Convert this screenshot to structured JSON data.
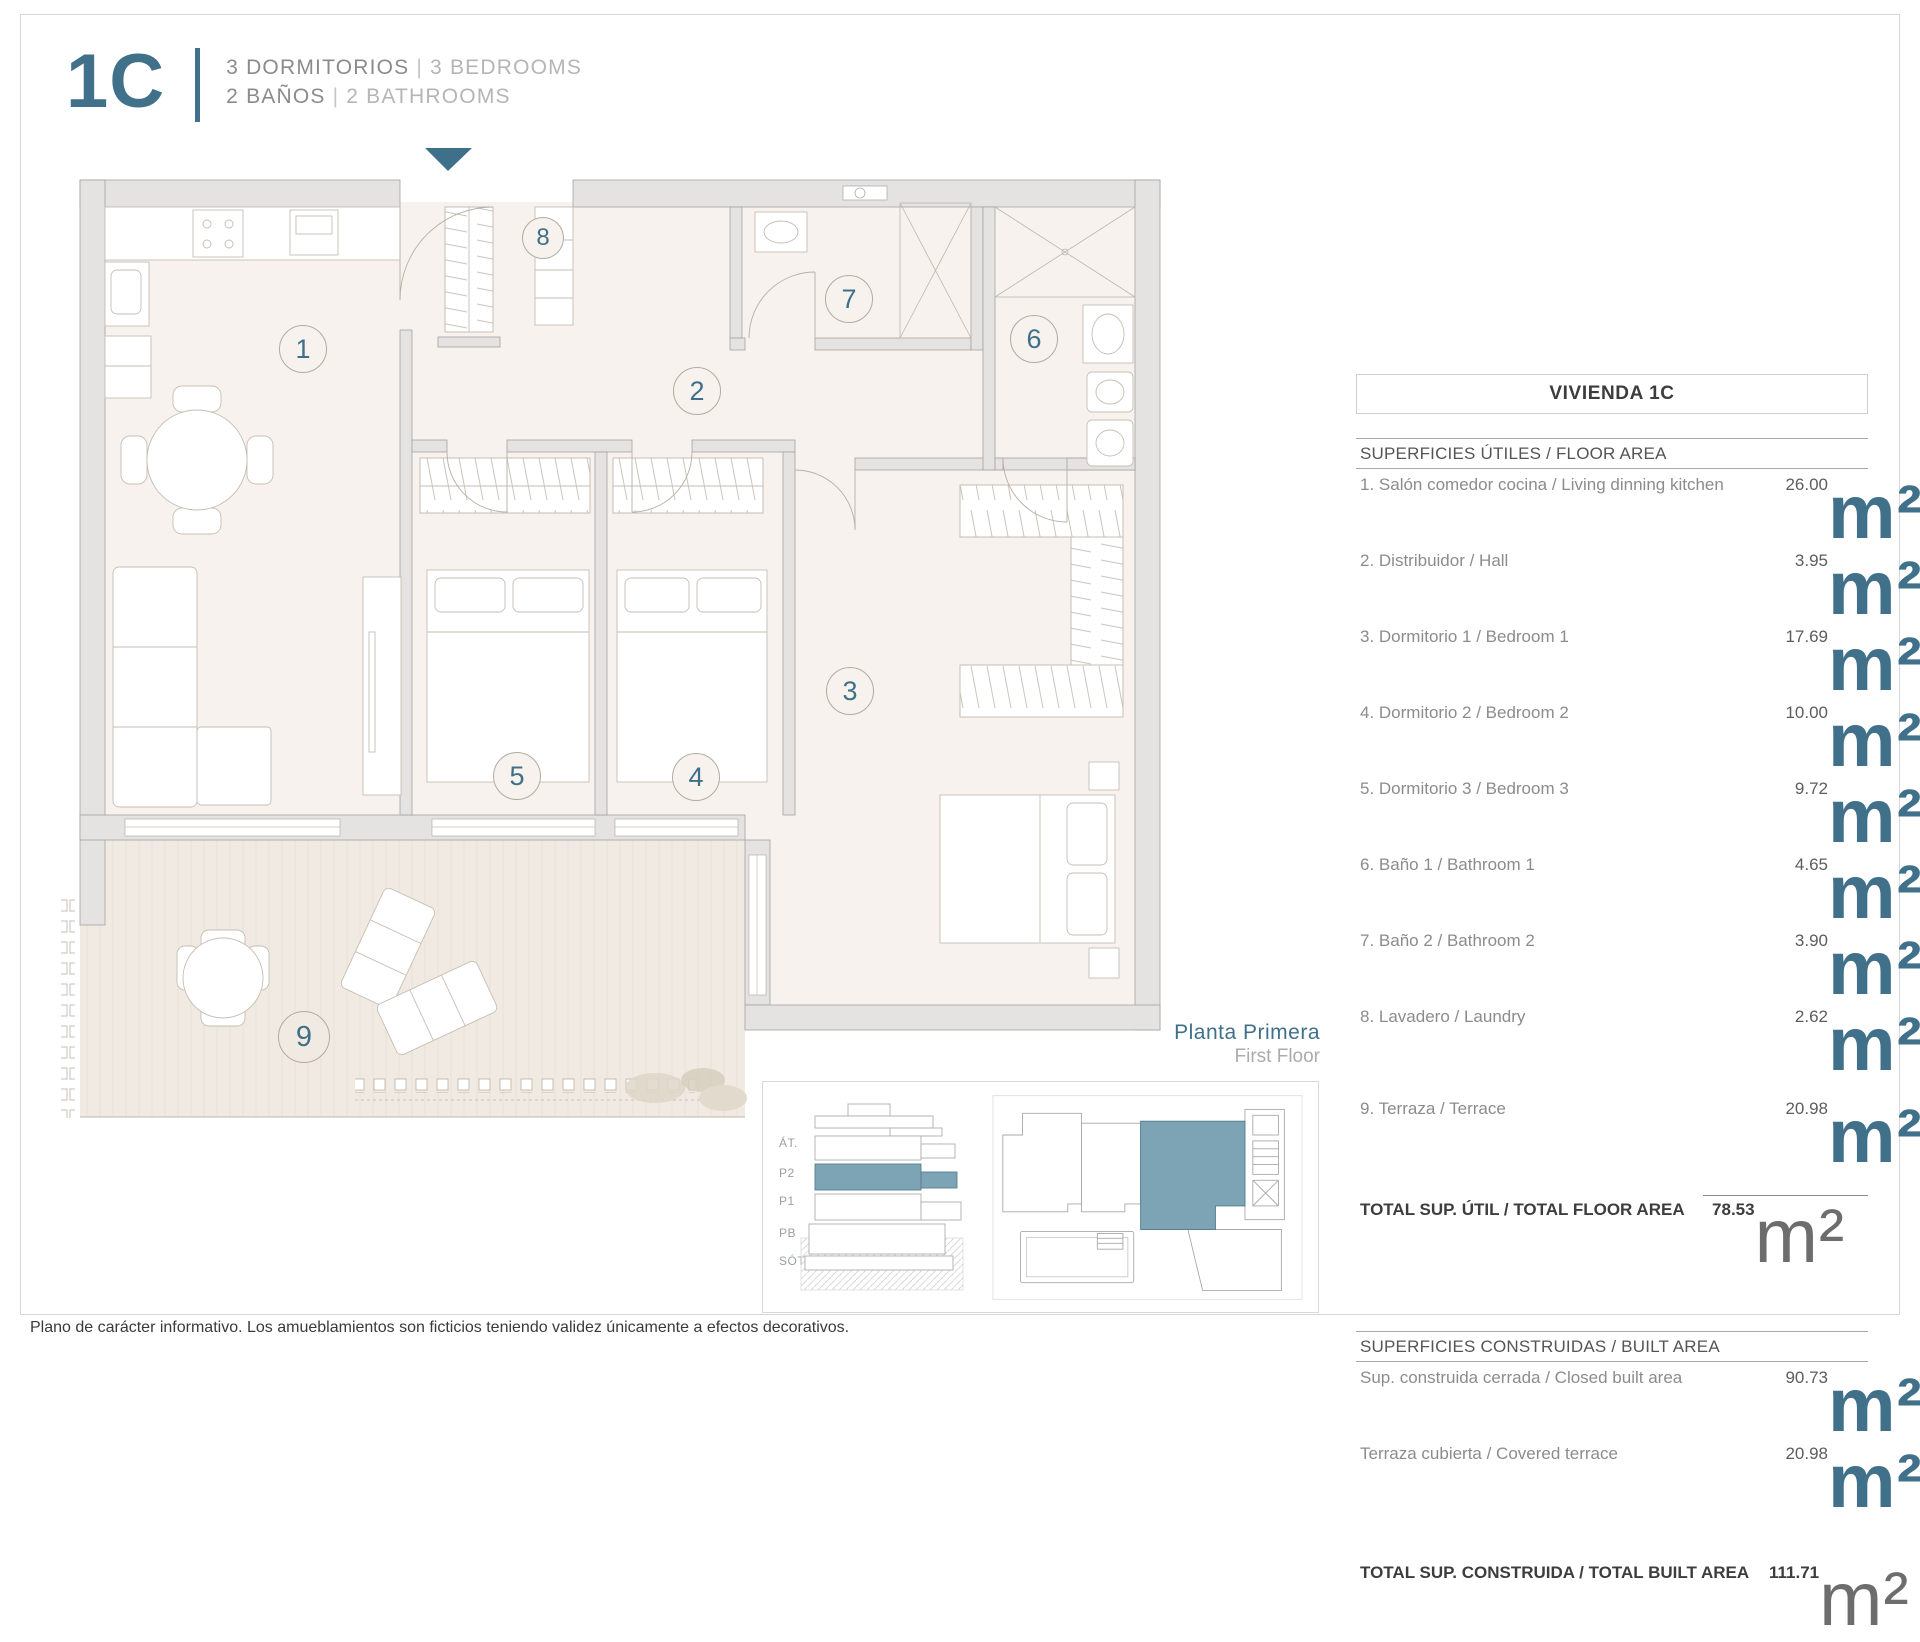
{
  "header": {
    "unit": "1C",
    "line1_es": "3 DORMITORIOS",
    "line1_en": "3 BEDROOMS",
    "line2_es": "2 BAÑOS",
    "line2_en": "2 BATHROOMS",
    "sep": "|"
  },
  "plan": {
    "rooms": [
      {
        "number": "1"
      },
      {
        "number": "2"
      },
      {
        "number": "3"
      },
      {
        "number": "4"
      },
      {
        "number": "5"
      },
      {
        "number": "6"
      },
      {
        "number": "7"
      },
      {
        "number": "8"
      },
      {
        "number": "9"
      }
    ]
  },
  "areas": {
    "title": "VIVIENDA 1C",
    "floor_area": {
      "heading": "SUPERFICIES ÚTILES / FLOOR AREA",
      "rows": [
        {
          "label": "1. Salón comedor cocina / Living dinning kitchen",
          "value": "26.00",
          "unit": "m²"
        },
        {
          "label": "2. Distribuidor / Hall",
          "value": "3.95",
          "unit": "m²"
        },
        {
          "label": "3. Dormitorio 1 / Bedroom 1",
          "value": "17.69",
          "unit": "m²"
        },
        {
          "label": "4. Dormitorio 2 / Bedroom 2",
          "value": "10.00",
          "unit": "m²"
        },
        {
          "label": "5. Dormitorio 3 / Bedroom 3",
          "value": "9.72",
          "unit": "m²"
        },
        {
          "label": "6. Baño 1 / Bathroom 1",
          "value": "4.65",
          "unit": "m²"
        },
        {
          "label": "7. Baño 2 / Bathroom 2",
          "value": "3.90",
          "unit": "m²"
        },
        {
          "label": "8. Lavadero / Laundry",
          "value": "2.62",
          "unit": "m²"
        }
      ],
      "terrace_row": {
        "label": "9. Terraza / Terrace",
        "value": "20.98",
        "unit": "m²"
      },
      "total": {
        "label": "TOTAL SUP. ÚTIL / TOTAL FLOOR AREA",
        "value": "78.53",
        "unit": "m²"
      }
    },
    "built_area": {
      "heading": "SUPERFICIES CONSTRUIDAS / BUILT AREA",
      "rows": [
        {
          "label": "Sup. construida cerrada / Closed built area",
          "value": "90.73",
          "unit": "m²"
        },
        {
          "label": "Terraza cubierta / Covered terrace",
          "value": "20.98",
          "unit": "m²"
        }
      ],
      "total": {
        "label": "TOTAL SUP. CONSTRUIDA /  TOTAL BUILT AREA",
        "value": "111.71",
        "unit": "m²"
      }
    }
  },
  "floor_label": {
    "es": "Planta Primera",
    "en": "First Floor"
  },
  "keymap": {
    "levels": [
      "ÁT.",
      "P2",
      "P1",
      "PB",
      "SÓT."
    ]
  },
  "footer": {
    "disclaimer": "Plano de carácter informativo. Los amueblamientos son ficticios teniendo validez únicamente a efectos decorativos."
  },
  "colors": {
    "accent": "#41718a",
    "highlight": "#7da4b5",
    "wall": "#e4e3e1",
    "floor": "#f8f2ee",
    "terrace": "#f1eae2"
  }
}
